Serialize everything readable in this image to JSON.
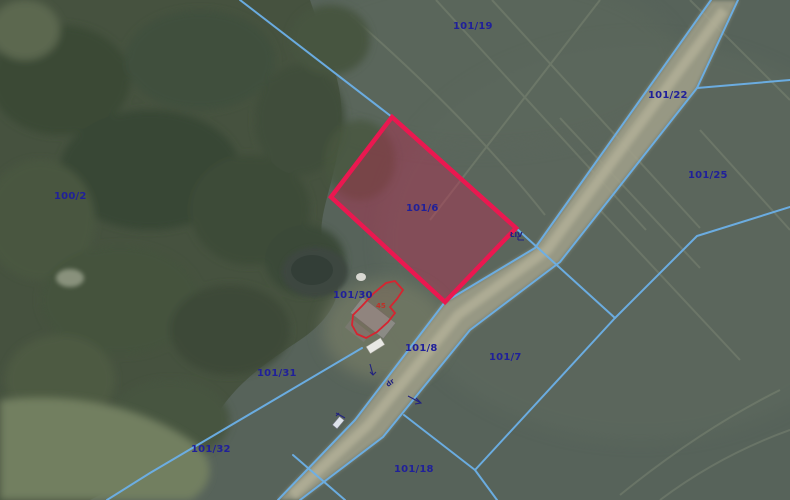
{
  "map": {
    "type": "cadastral-aerial-map-view",
    "highlighted_parcel": {
      "id": "101/6",
      "outline_color": "#ea1850",
      "fill_color": "rgba(207,32,80,0.35)"
    },
    "parcel_labels": [
      {
        "id": "101/19"
      },
      {
        "id": "101/22"
      },
      {
        "id": "101/25"
      },
      {
        "id": "100/2"
      },
      {
        "id": "101/6"
      },
      {
        "id": "101/30"
      },
      {
        "id": "101/8"
      },
      {
        "id": "101/7"
      },
      {
        "id": "101/31"
      },
      {
        "id": "101/32"
      },
      {
        "id": "101/18"
      }
    ],
    "land_use_symbol": "ŁIV",
    "road_symbol": "dr",
    "building_label": "45",
    "colors": {
      "boundary_line_blue": "#6cb0e8",
      "label_navy": "#20209a",
      "building_outline_red": "#d62430",
      "road_surface": "#a2a18b",
      "forest_green": "#46523f",
      "field_green": "#57635a"
    }
  }
}
